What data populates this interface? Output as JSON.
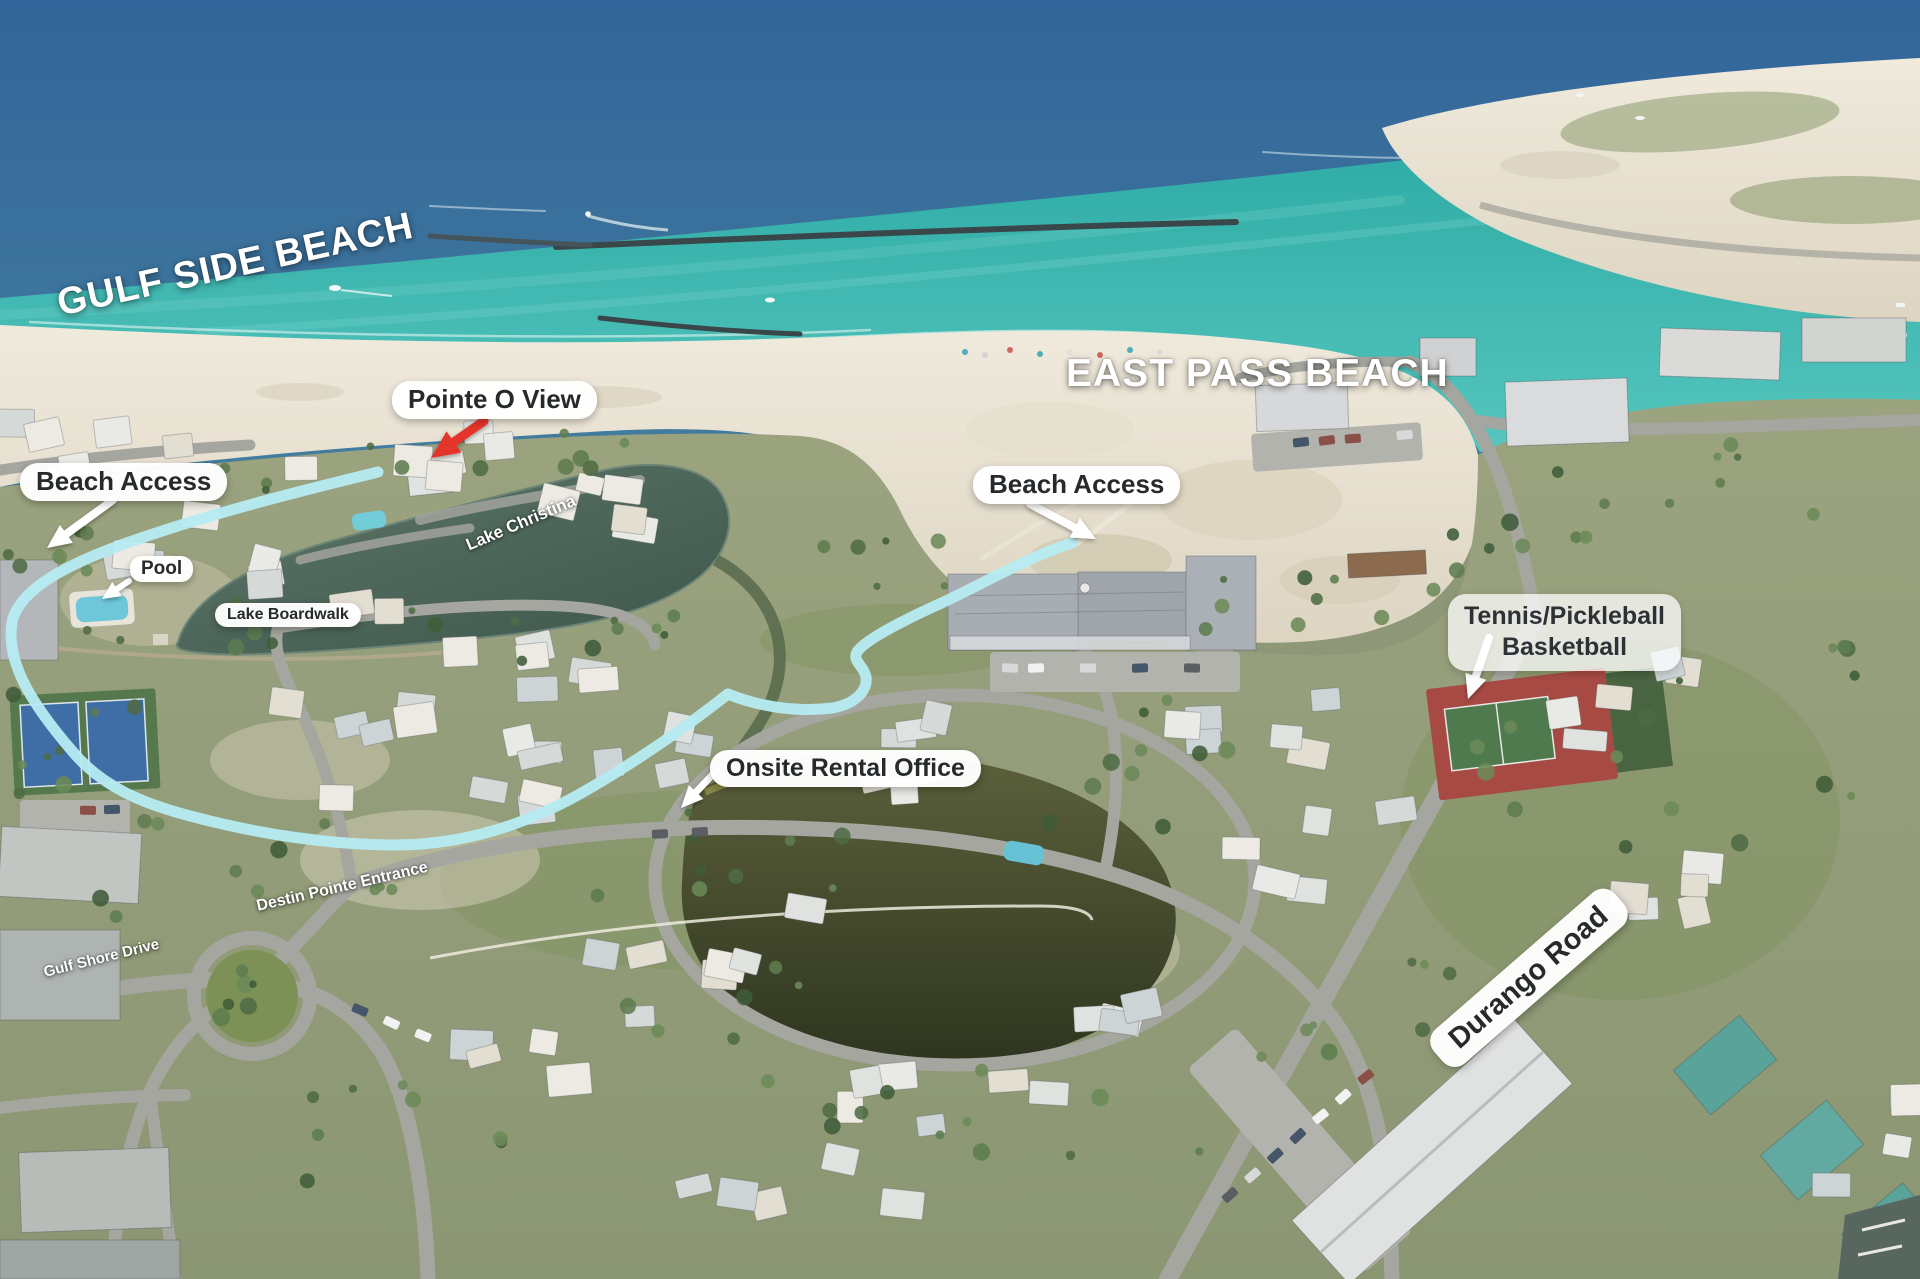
{
  "labels": {
    "gulf_side_beach": "GULF SIDE BEACH",
    "east_pass_beach": "EAST PASS BEACH",
    "pointe_o_view": "Pointe O View",
    "beach_access_left": "Beach Access",
    "beach_access_center": "Beach Access",
    "pool": "Pool",
    "lake_christina": "Lake Christina",
    "lake_boardwalk": "Lake Boardwalk",
    "tennis_line1": "Tennis/Pickleball",
    "tennis_line2": "Basketball",
    "onsite_rental_office": "Onsite Rental Office",
    "destin_pointe_entrance": "Destin Pointe Entrance",
    "gulf_shore_drive": "Gulf Shore Drive",
    "durango_road": "Durango Road"
  },
  "colors": {
    "route_highlight": "#b6ecf2",
    "pointer_arrow_red": "#e5352b",
    "pointer_arrow_white": "#ffffff",
    "deep_water": "#38699b",
    "shallow_water": "#2fb3af"
  }
}
